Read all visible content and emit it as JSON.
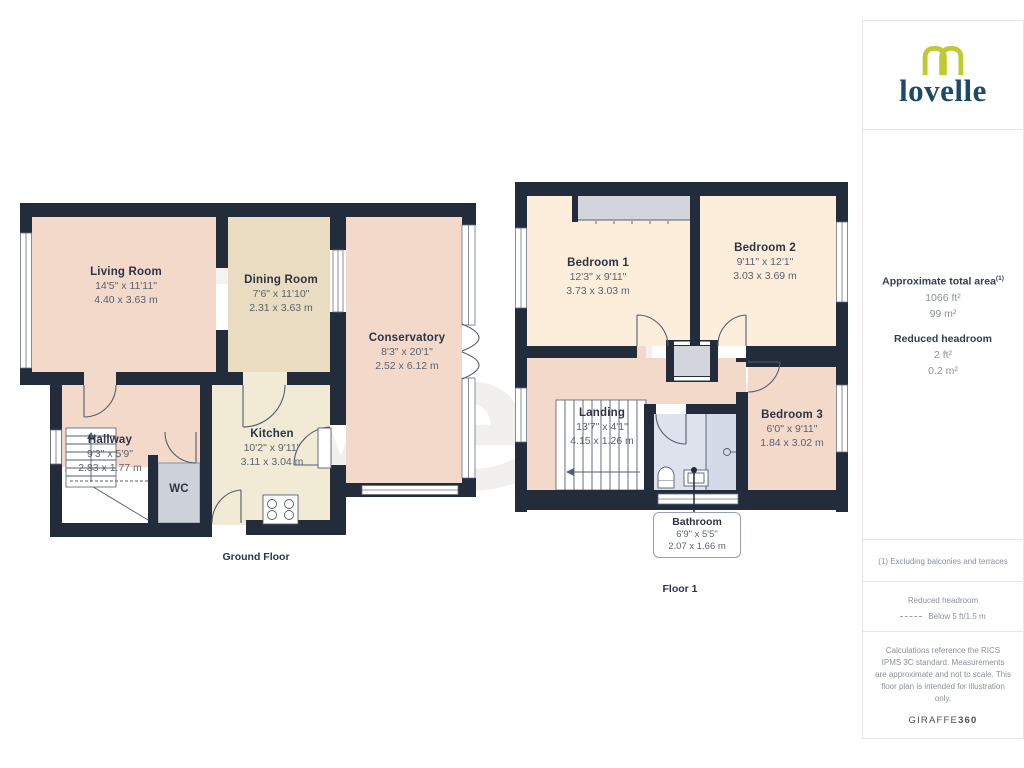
{
  "branding": {
    "logo_text": "lovelle",
    "watermark_text": "lovelle",
    "footer_brand": "GIRAFFE",
    "footer_brand_bold": "360"
  },
  "colors": {
    "wall": "#222c3b",
    "room_pink": "#f3d9c9",
    "room_tan": "#e9dcc1",
    "room_cream": "#f1ebd6",
    "room_peach": "#fdeedc",
    "bathroom_blue": "#dde2ed",
    "logo_green": "#bfca31",
    "logo_navy": "#1d4a66"
  },
  "floors": {
    "ground": {
      "caption": "Ground Floor",
      "rooms": {
        "living": {
          "name": "Living Room",
          "imperial": "14'5\" x 11'11\"",
          "metric": "4.40 x 3.63 m"
        },
        "dining": {
          "name": "Dining Room",
          "imperial": "7'6\" x 11'10\"",
          "metric": "2.31 x 3.63 m"
        },
        "conservatory": {
          "name": "Conservatory",
          "imperial": "8'3\" x 20'1\"",
          "metric": "2.52 x 6.12 m"
        },
        "kitchen": {
          "name": "Kitchen",
          "imperial": "10'2\" x 9'11\"",
          "metric": "3.11 x 3.04 m"
        },
        "hallway": {
          "name": "Hallway",
          "imperial": "9'3\" x 5'9\"",
          "metric": "2.83 x 1.77 m"
        },
        "wc": {
          "name": "WC"
        }
      }
    },
    "first": {
      "caption": "Floor 1",
      "rooms": {
        "bedroom1": {
          "name": "Bedroom 1",
          "imperial": "12'3\" x 9'11\"",
          "metric": "3.73 x 3.03 m"
        },
        "bedroom2": {
          "name": "Bedroom 2",
          "imperial": "9'11\" x 12'1\"",
          "metric": "3.03 x 3.69 m"
        },
        "bedroom3": {
          "name": "Bedroom 3",
          "imperial": "6'0\" x 9'11\"",
          "metric": "1.84 x 3.02 m"
        },
        "landing": {
          "name": "Landing",
          "imperial": "13'7\" x 4'1\"",
          "metric": "4.15 x 1.26 m"
        },
        "bathroom": {
          "name": "Bathroom",
          "imperial": "6'9\" x 5'5\"",
          "metric": "2.07 x 1.66 m"
        }
      }
    }
  },
  "sidebar": {
    "area_title": "Approximate total area",
    "area_footnote_marker": "(1)",
    "area_imperial": "1066 ft²",
    "area_metric": "99 m²",
    "headroom_title": "Reduced headroom",
    "headroom_imperial": "2 ft²",
    "headroom_metric": "0.2 m²",
    "footnote": "(1) Excluding balconies and terraces",
    "legend_title": "Reduced headroom",
    "legend_label": "Below 5 ft/1.5 m",
    "disclaimer": "Calculations reference the RICS IPMS 3C standard. Measurements are approximate and not to scale. This floor plan is intended for illustration only."
  }
}
